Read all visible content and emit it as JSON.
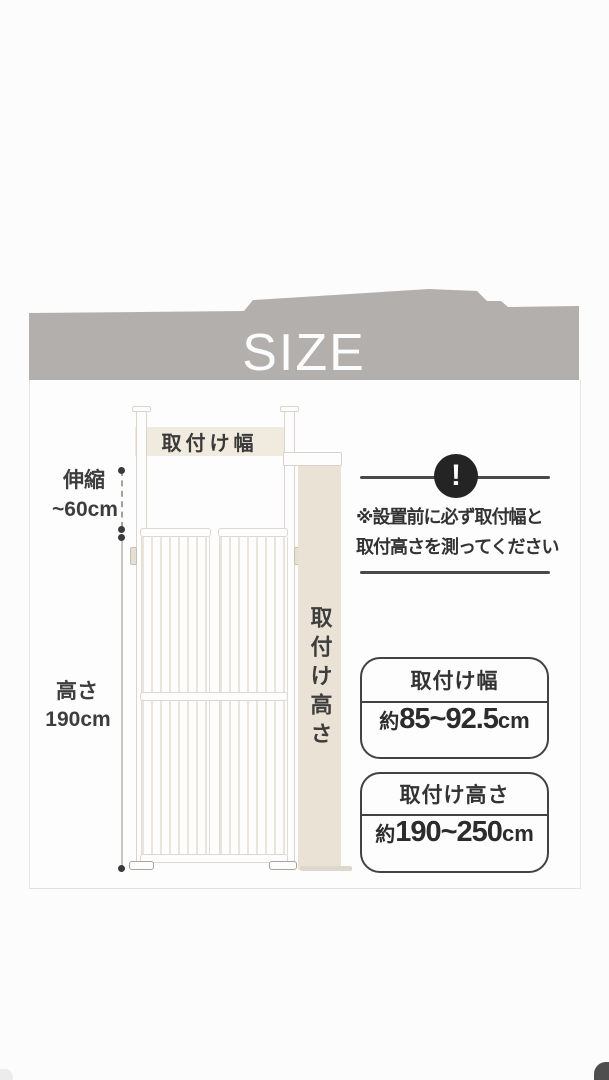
{
  "banner": {
    "title": "SIZE"
  },
  "diagram": {
    "width_band_label": "取付け幅",
    "extend_label_top": "伸縮",
    "extend_label_bottom": "~60cm",
    "height_label_top": "高さ",
    "height_label_bottom": "190cm",
    "wall_height_label": "取付け高さ"
  },
  "notice": {
    "icon_glyph": "!",
    "line1": "※設置前に必ず取付幅と",
    "line2": "取付高さを測ってください"
  },
  "spec_boxes": [
    {
      "label": "取付け幅",
      "prefix": "約",
      "range": "85~92.5",
      "unit": "cm"
    },
    {
      "label": "取付け高さ",
      "prefix": "約",
      "range": "190~250",
      "unit": "cm"
    }
  ],
  "colors": {
    "banner_gray": "#b3afac",
    "wall_beige": "#eae3d5",
    "band_beige": "#f1ebdf",
    "ink": "#3b3b3b",
    "box_border": "#424242",
    "next_image_corner": "#4e4e4e"
  }
}
